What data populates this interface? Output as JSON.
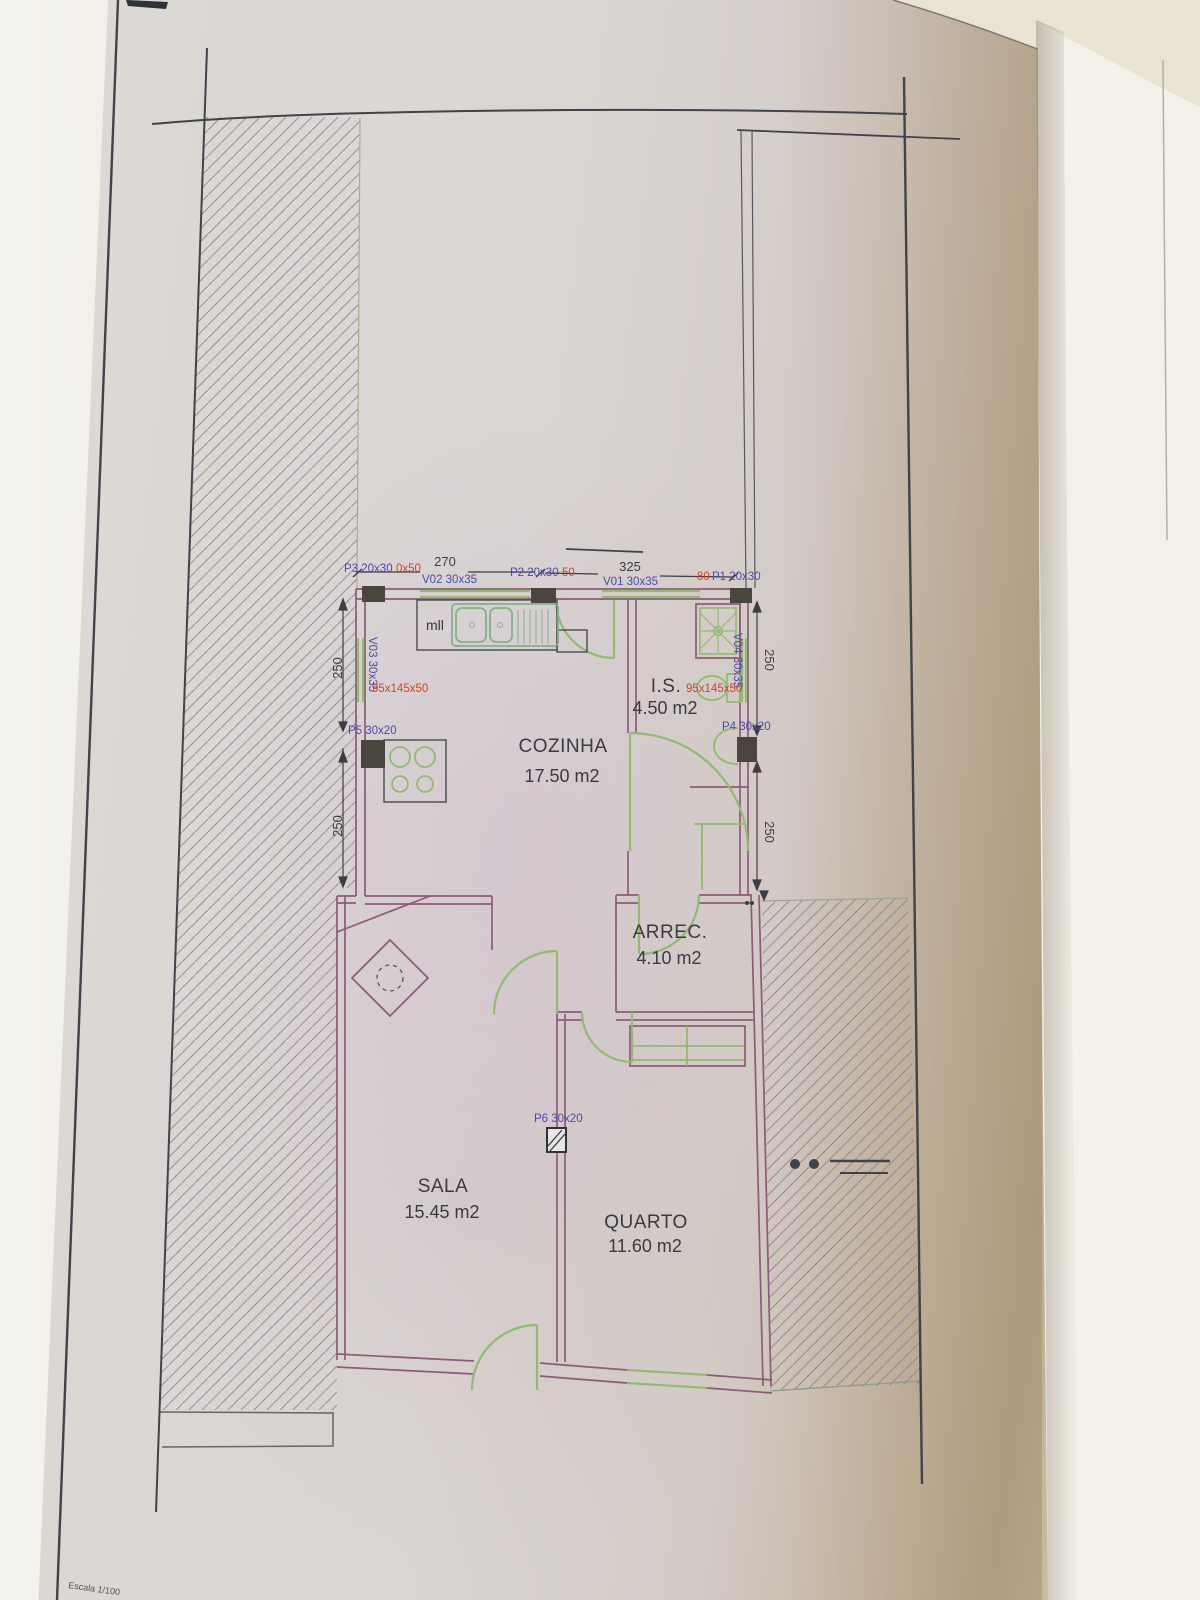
{
  "page": {
    "scale_label": "Escala 1/100"
  },
  "plan": {
    "rooms": [
      {
        "name": "COZINHA",
        "area": "17.50 m2"
      },
      {
        "name": "I.S.",
        "area": "4.50 m2"
      },
      {
        "name": "ARREC.",
        "area": "4.10 m2"
      },
      {
        "name": "SALA",
        "area": "15.45 m2"
      },
      {
        "name": "QUARTO",
        "area": "11.60 m2"
      }
    ],
    "doors": [
      {
        "label": "P1 20x30",
        "note": "80"
      },
      {
        "label": "P2 20x30",
        "note": "50"
      },
      {
        "label": "P3 20x30",
        "note": "0x50"
      },
      {
        "label": "P4 30x20"
      },
      {
        "label": "P5 30x20"
      },
      {
        "label": "P6 30x20"
      }
    ],
    "windows": [
      {
        "label": "V01 30x35"
      },
      {
        "label": "V02 30x35"
      },
      {
        "label": "V03 30x35"
      },
      {
        "label": "V04 30x35"
      }
    ],
    "dims": {
      "top_a": "270",
      "top_b": "325",
      "left_a": "250",
      "left_b": "250",
      "right_a": "250",
      "right_b": "250"
    },
    "annotations": {
      "kitchen_unit": "95x145x50",
      "bath_unit": "95x145x50",
      "mll": "mll"
    },
    "colors": {
      "wall": "#8d5a78",
      "fixture": "#92ba70",
      "label": "#5149a8",
      "red": "#cc4522",
      "ink": "#3f434a",
      "pillar": "#4b463d"
    }
  }
}
